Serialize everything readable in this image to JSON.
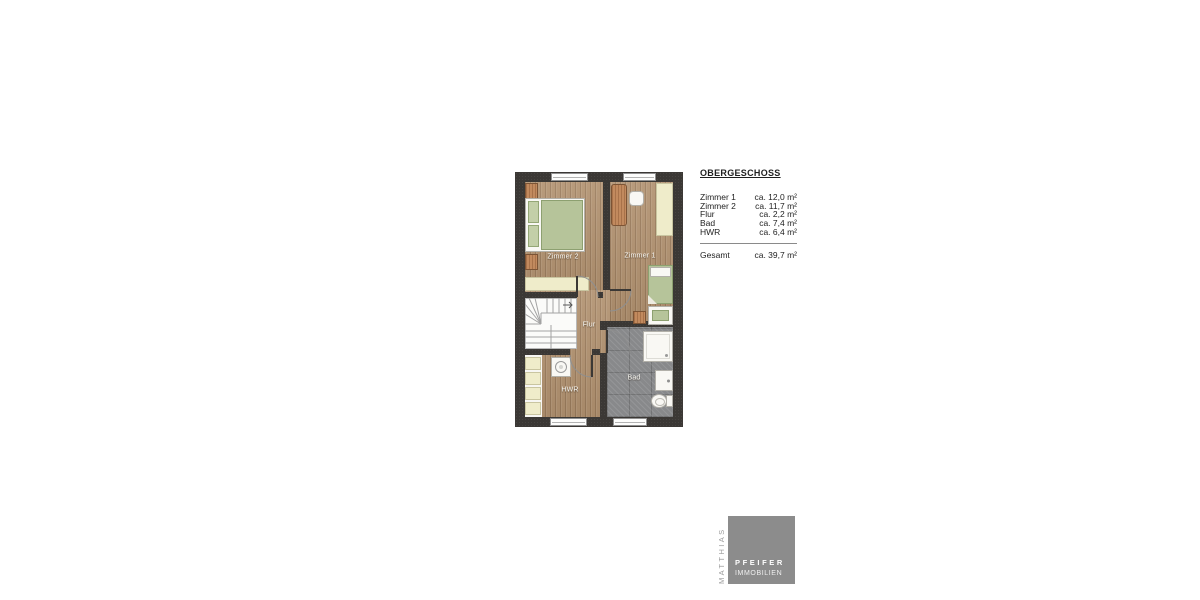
{
  "legend": {
    "title": "OBERGESCHOSS",
    "rows": [
      {
        "label": "Zimmer 1",
        "value": "ca. 12,0 m²"
      },
      {
        "label": "Zimmer 2",
        "value": "ca. 11,7 m²"
      },
      {
        "label": "Flur",
        "value": "ca. 2,2 m²"
      },
      {
        "label": "Bad",
        "value": "ca. 7,4 m²"
      },
      {
        "label": "HWR",
        "value": "ca. 6,4 m²"
      }
    ],
    "total": {
      "label": "Gesamt",
      "value": "ca. 39,7 m²"
    }
  },
  "plan": {
    "room_labels": {
      "zimmer2": "Zimmer 2",
      "zimmer1": "Zimmer 1",
      "flur": "Flur",
      "hwr": "HWR",
      "bad": "Bad"
    }
  },
  "logo": {
    "vertical_text": "MATTHIAS",
    "name": "PFEIFER",
    "subtitle": "IMMOBILIEN"
  },
  "colors": {
    "wall": "#3b3835",
    "wood_floor": "#b1916f",
    "tile_floor": "#88898b",
    "furniture_green": "#b6c49a",
    "furniture_cream": "#efecca",
    "furniture_wood": "#c28a5e",
    "logo_gray": "#8c8c8c"
  }
}
